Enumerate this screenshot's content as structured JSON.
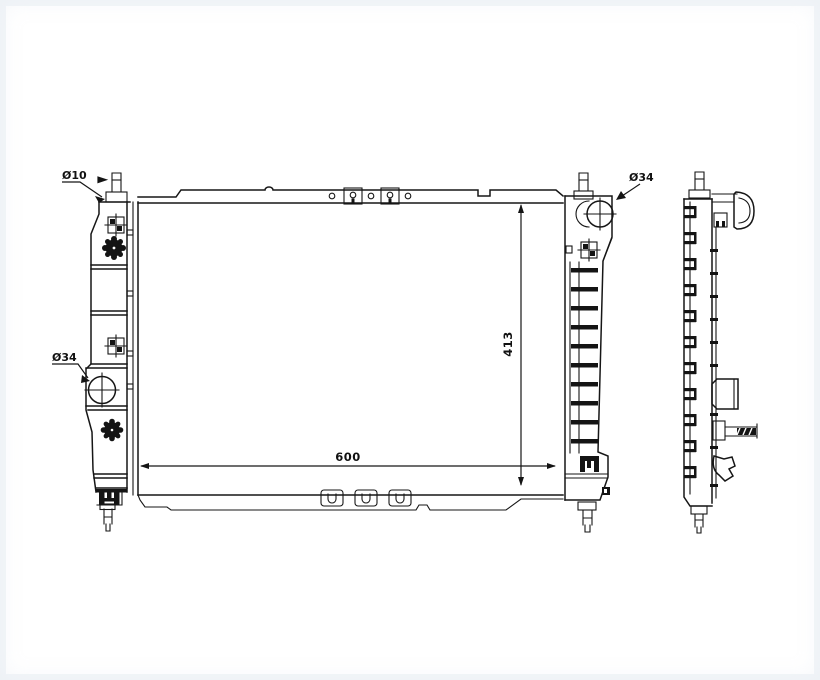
{
  "drawing": {
    "type": "technical-line-drawing",
    "subject": "automotive radiator - front view and side profile view",
    "dimensions": {
      "core_width": "600",
      "core_height": "413"
    },
    "callouts": {
      "top_pin_diameter": "Ø10",
      "left_port_diameter": "Ø34",
      "filler_neck_diameter": "Ø34"
    },
    "colors": {
      "line": "#161616",
      "background": "#ffffff",
      "edge_frame": "#e7ecf3"
    }
  }
}
